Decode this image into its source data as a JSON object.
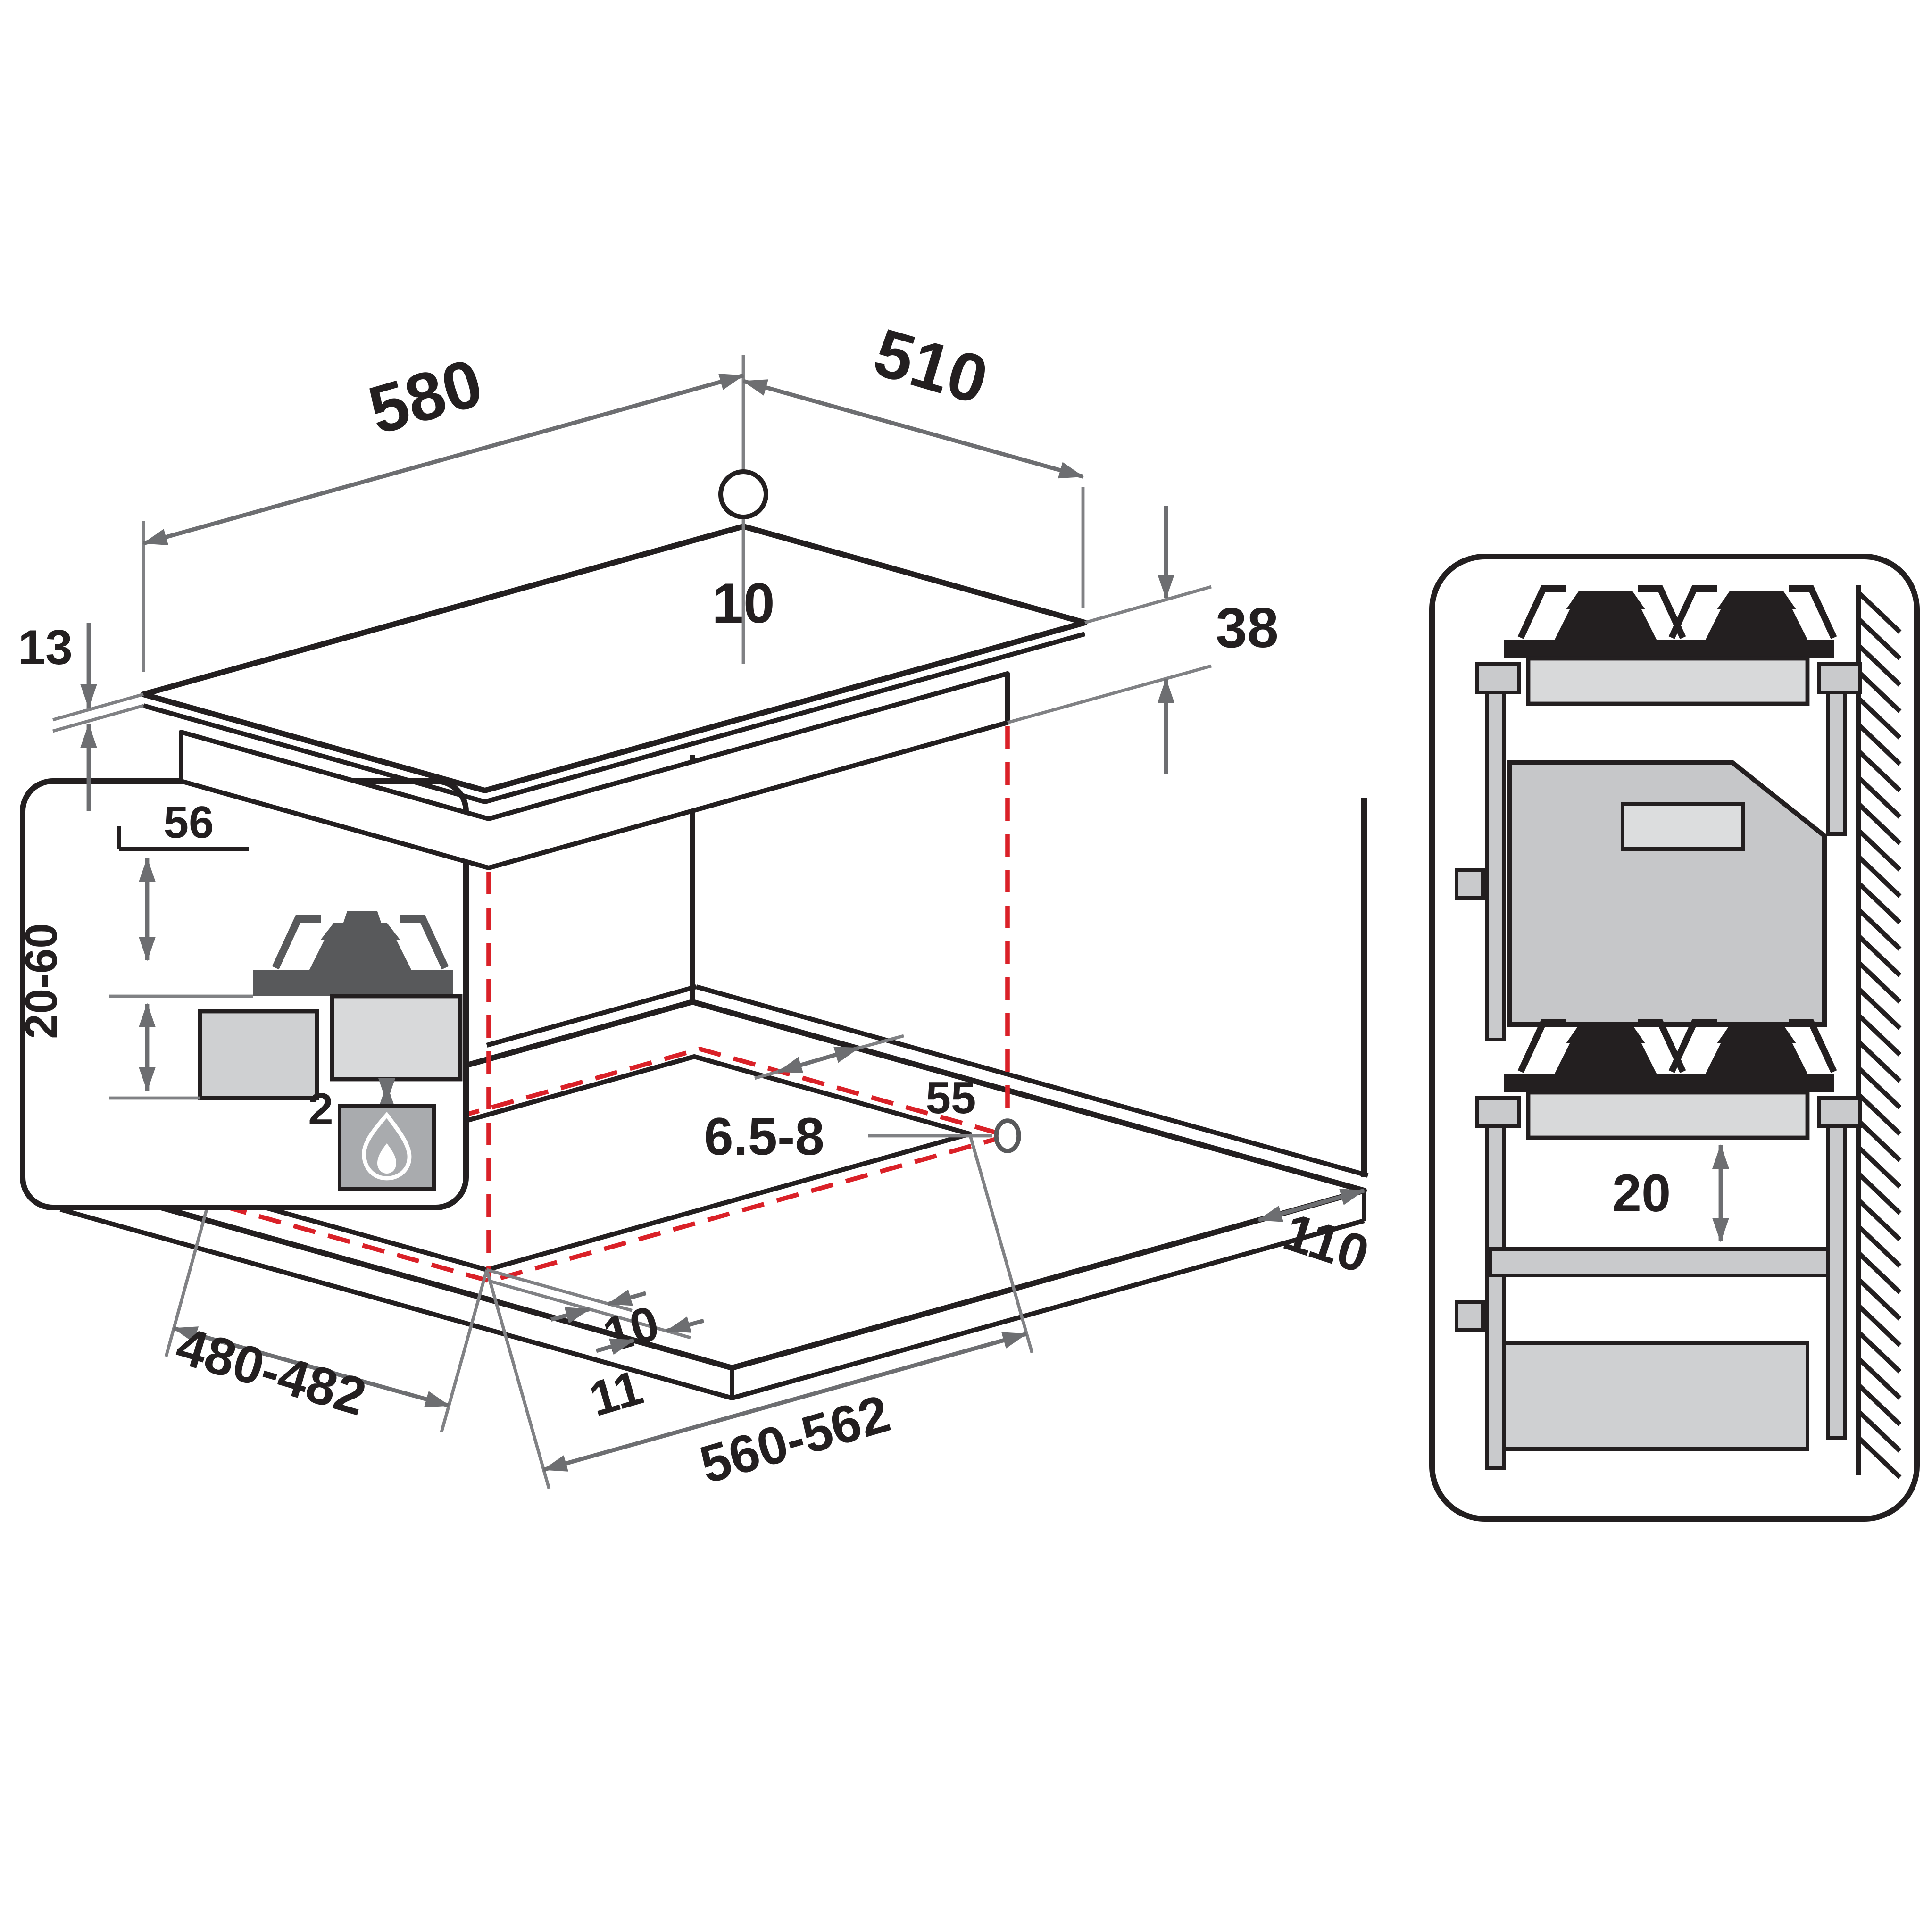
{
  "diagram": {
    "hob": {
      "width": "580",
      "depth": "510",
      "hole_diameter": "10",
      "glass_thickness": "13",
      "body_height": "38"
    },
    "burner_detail": {
      "burner_height": "56",
      "worktop_range": "20-60",
      "bottom_gap": "2"
    },
    "cutout": {
      "rear_clearance": "55",
      "fixing_hole": "6.5-8",
      "depth": "480-482",
      "width": "560-562",
      "side_clearance": "110",
      "front_offset": "10",
      "side_offset": "11"
    },
    "section": {
      "shelf_clearance": "20"
    },
    "colors": {
      "line": "#231f20",
      "dimension": "#6d6e71",
      "projection_red": "#da2128",
      "dark_gray": "#58595b",
      "light_gray": "#d8d9da",
      "mid_gray": "#c9cacc"
    }
  }
}
